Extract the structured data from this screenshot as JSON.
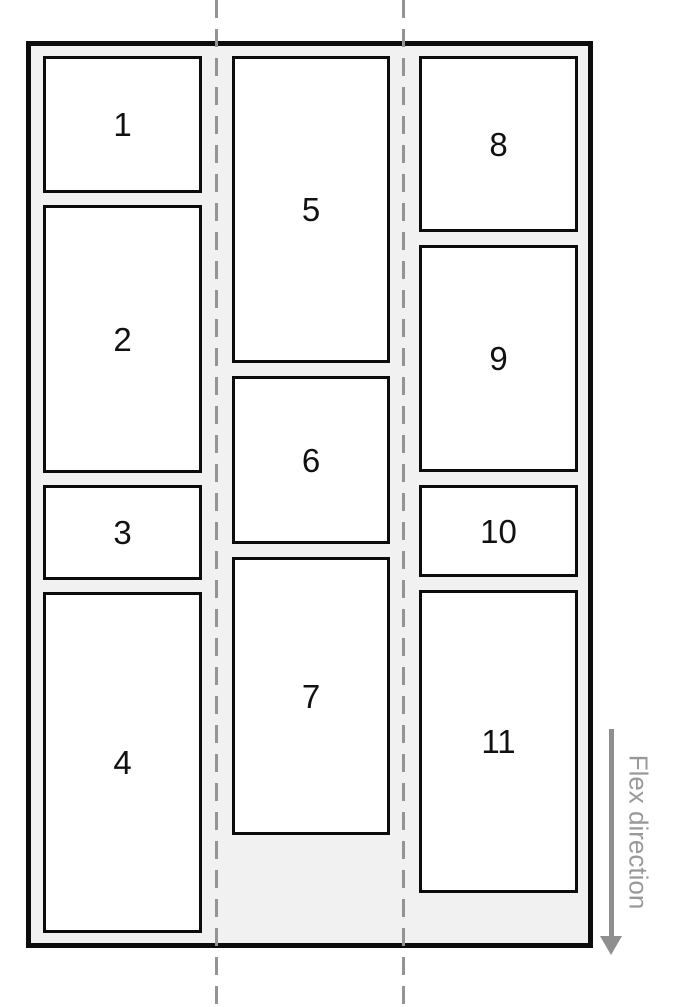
{
  "container": {
    "columns": [
      {
        "boxes": [
          {
            "label": "1"
          },
          {
            "label": "2"
          },
          {
            "label": "3"
          },
          {
            "label": "4"
          }
        ]
      },
      {
        "boxes": [
          {
            "label": "5"
          },
          {
            "label": "6"
          },
          {
            "label": "7"
          }
        ]
      },
      {
        "boxes": [
          {
            "label": "8"
          },
          {
            "label": "9"
          },
          {
            "label": "10"
          },
          {
            "label": "11"
          }
        ]
      }
    ]
  },
  "annotation": {
    "label": "Flex direction",
    "arrow_icon": "arrow-down"
  },
  "colors": {
    "page_bg": "#ffffff",
    "container_bg": "#f1f1f1",
    "border": "#0c0c0c",
    "box_bg": "#ffffff",
    "guide_line": "#949494",
    "annotation": "#8f8f8f",
    "label_text": "#999999"
  }
}
